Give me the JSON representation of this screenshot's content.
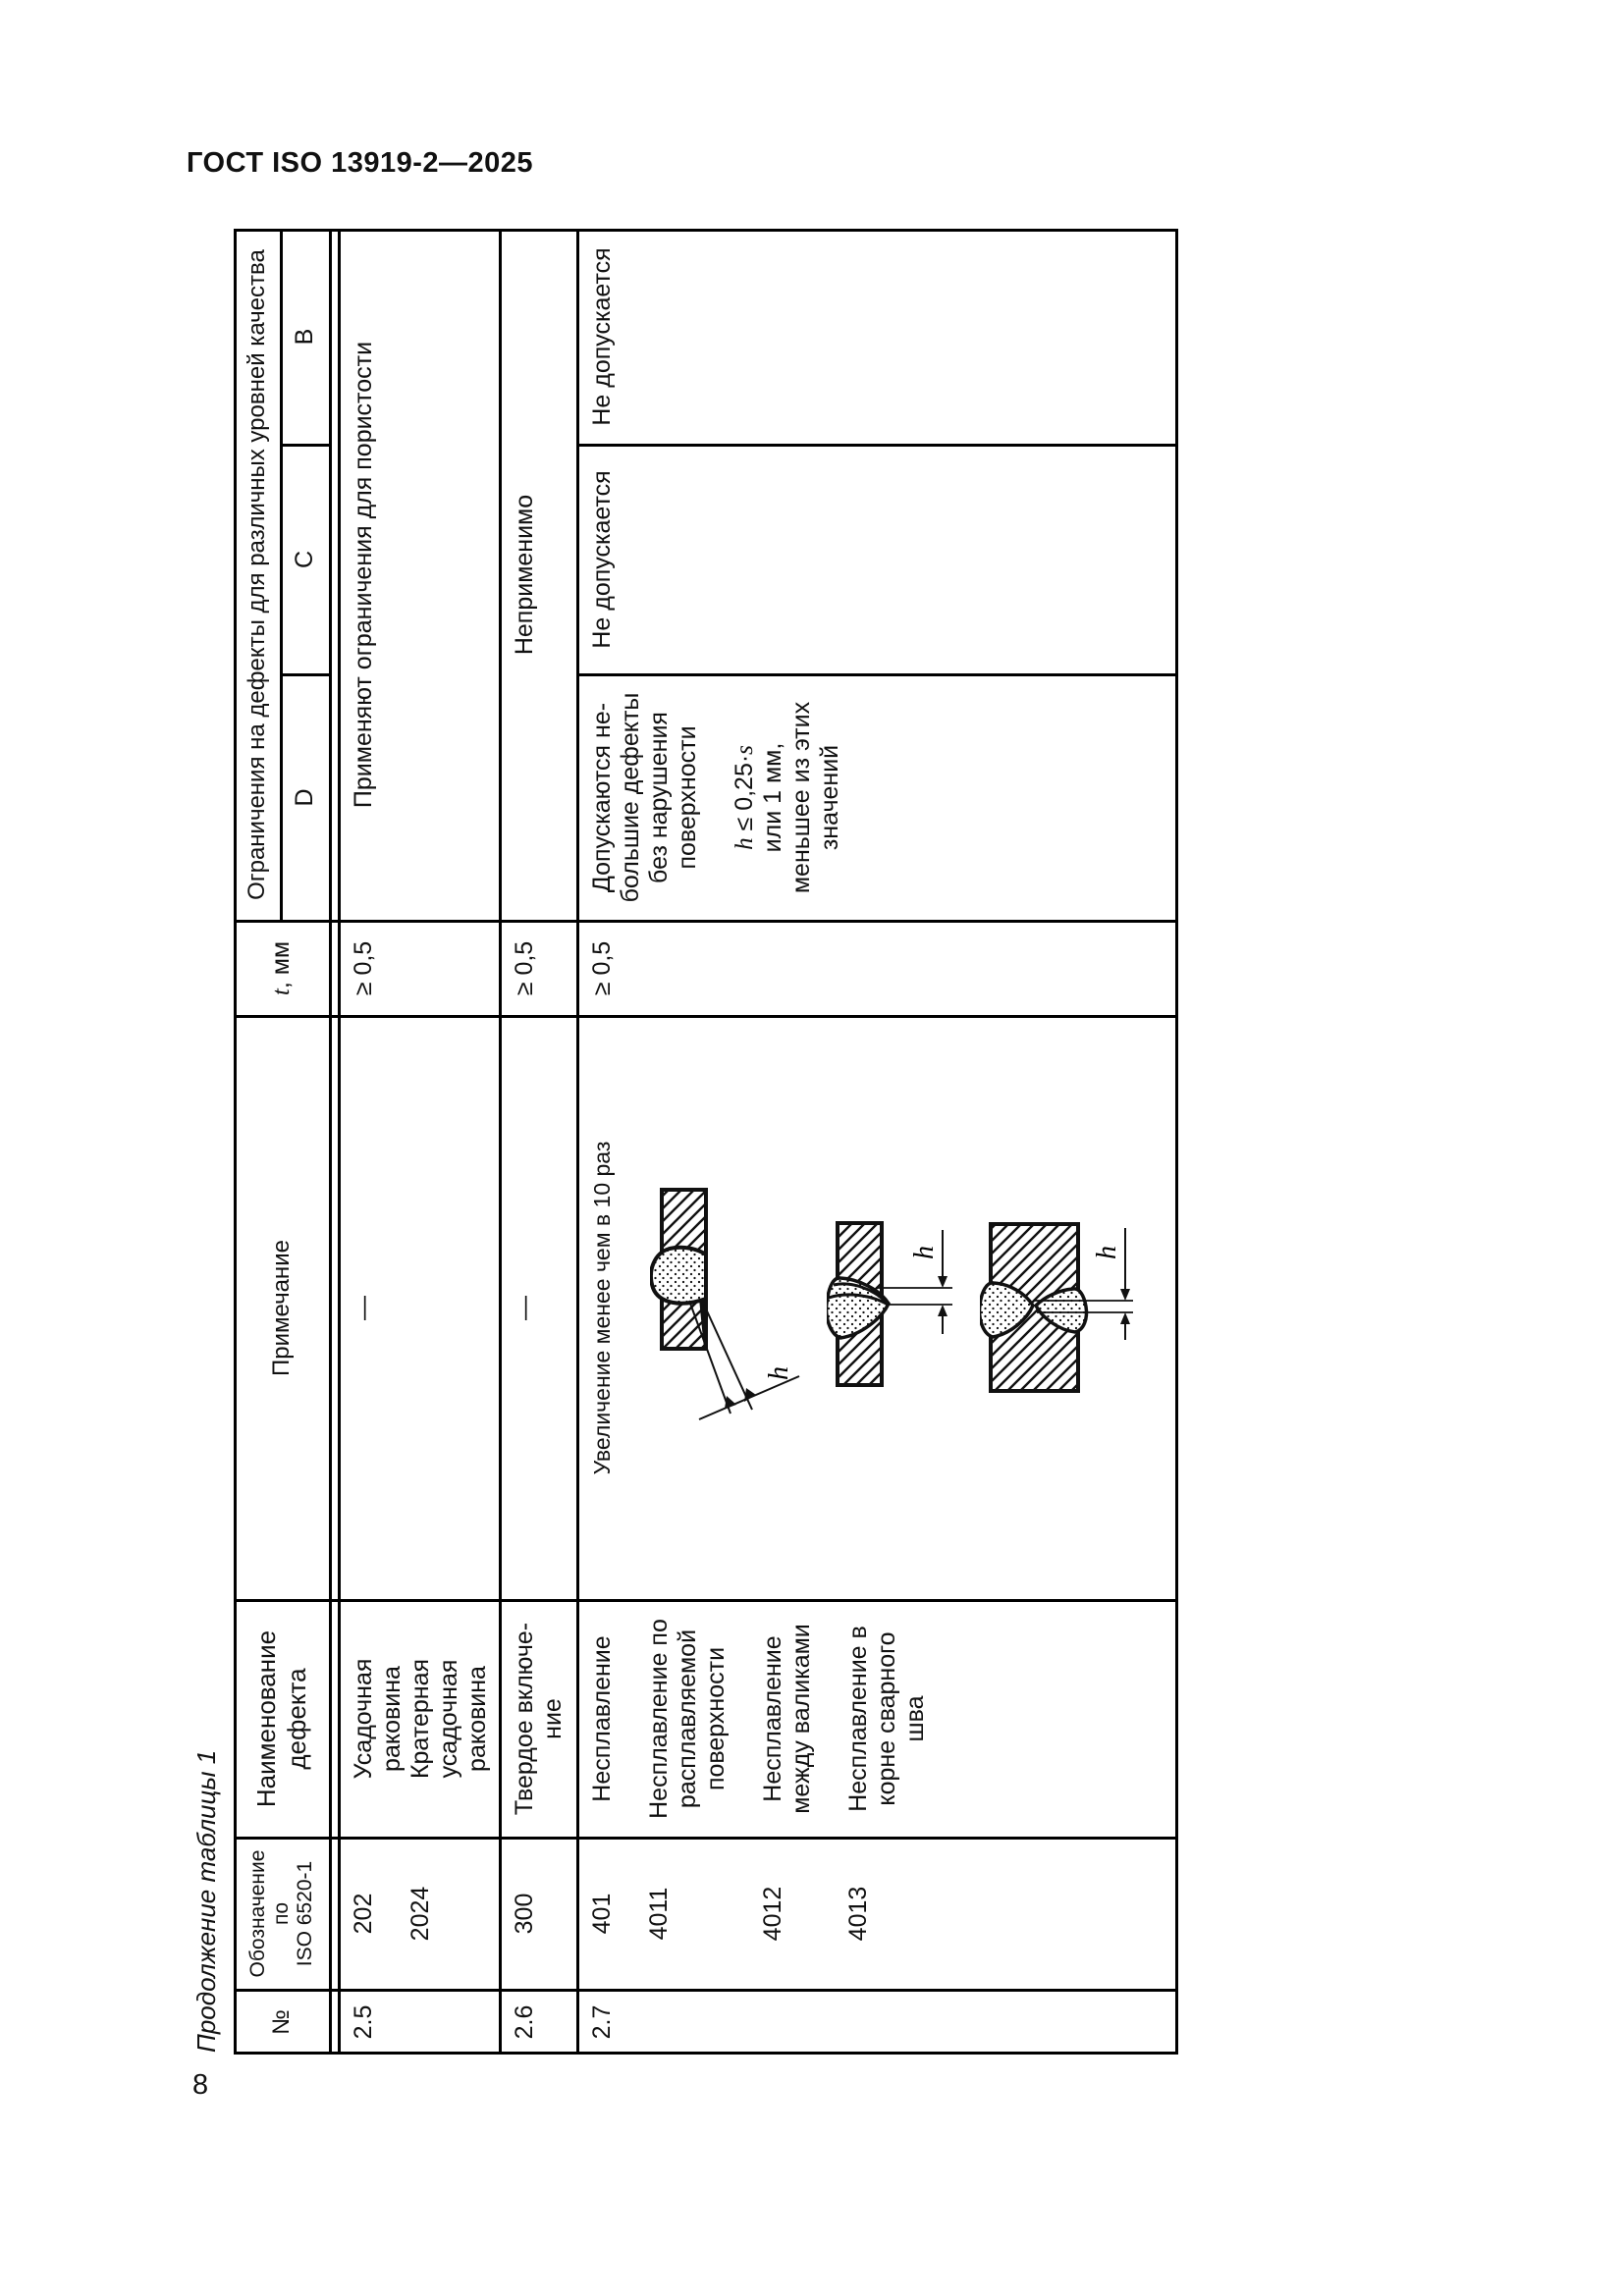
{
  "page": {
    "header_title": "ГОСТ ISO 13919-2—2025",
    "table_caption": "Продолжение таблицы 1",
    "page_number": "8"
  },
  "table": {
    "headers": {
      "num": "№",
      "designation": [
        "Обозначение",
        "по",
        "ISO 6520-1"
      ],
      "name": [
        "Наименование",
        "дефекта"
      ],
      "note": "Примечание",
      "t_var": "t",
      "t_unit": ", мм",
      "limits_group": "Ограничения на дефекты для различных уровней качества",
      "levels": [
        "D",
        "C",
        "B"
      ]
    },
    "rows": {
      "r25": {
        "num": "2.5",
        "code1": "202",
        "code2": "2024",
        "name_lines": [
          "Усадочная",
          "раковина",
          "Кратерная",
          "усадочная",
          "раковина"
        ],
        "note": "—",
        "t": "≥ 0,5",
        "limits_merged": "Применяют ограничения для пористости"
      },
      "r26": {
        "num": "2.6",
        "code": "300",
        "name_lines": [
          "Твердое включе-",
          "ние"
        ],
        "note": "—",
        "t": "≥ 0,5",
        "limits_merged": "Неприменимо"
      },
      "r27": {
        "num": "2.7",
        "codes": [
          "401",
          "4011",
          "4012",
          "4013"
        ],
        "name1": [
          "Несплавление"
        ],
        "name2": [
          "Несплавление по",
          "расплавляемой",
          "поверхности"
        ],
        "name3": [
          "Несплавление",
          "между валиками"
        ],
        "name4": [
          "Несплавление в",
          "корне сварного",
          "шва"
        ],
        "note_text": "Увеличение менее чем в 10 раз",
        "t": "≥ 0,5",
        "d_lines": [
          "Допускаются не-",
          "большие дефекты",
          "без нарушения",
          "поверхности"
        ],
        "d_formula": {
          "h": "h",
          "rel": " ≤ 0,25·",
          "s": "s"
        },
        "d_lines2": [
          "или 1 мм,",
          "меньшее из этих",
          "значений"
        ],
        "c": "Не допускается",
        "b": "Не допускается",
        "fig_label": "h"
      }
    }
  }
}
